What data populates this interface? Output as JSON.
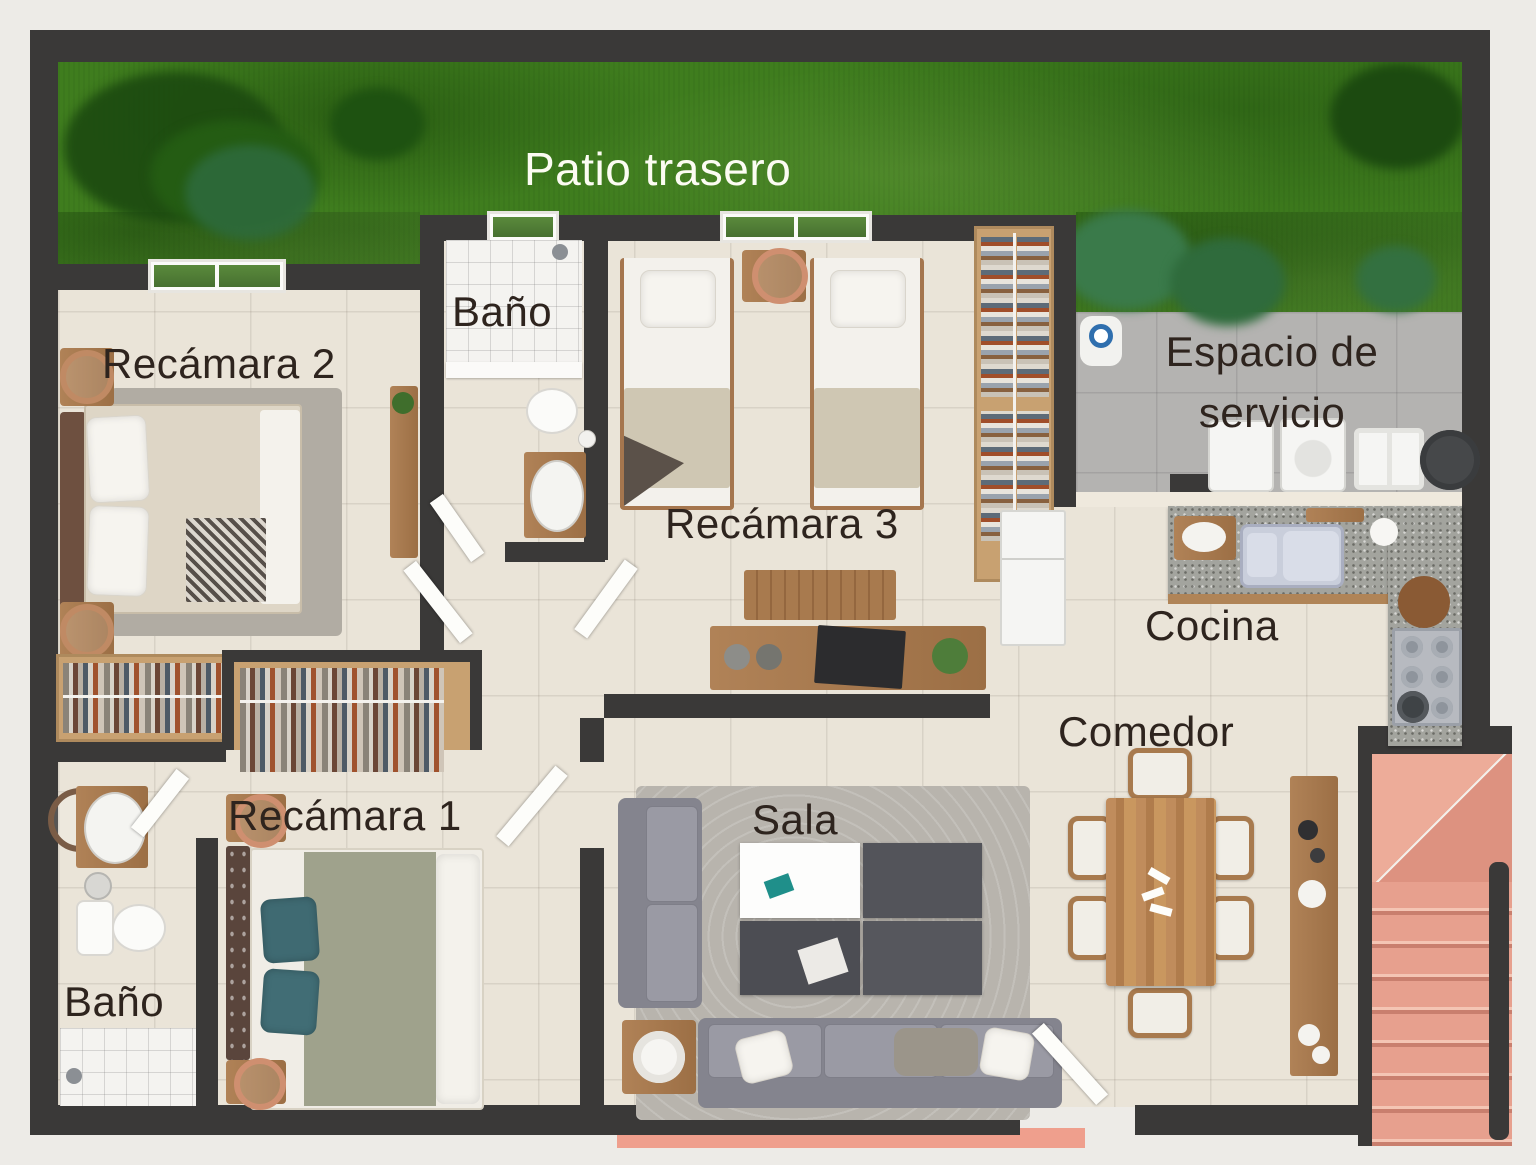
{
  "title": "Planta arquitectónica de casa (render 3D, vista superior)",
  "rooms": {
    "patio": {
      "label": "Patio trasero"
    },
    "bano_top": {
      "label": "Baño"
    },
    "recamara2": {
      "label": "Recámara 2"
    },
    "recamara3": {
      "label": "Recámara 3"
    },
    "espacio_servicio": {
      "line1": "Espacio de",
      "line2": "servicio"
    },
    "cocina": {
      "label": "Cocina"
    },
    "comedor": {
      "label": "Comedor"
    },
    "sala": {
      "label": "Sala"
    },
    "recamara1": {
      "label": "Recámara 1"
    },
    "bano_bottom": {
      "label": "Baño"
    }
  },
  "palette": {
    "wall": "#3a3938",
    "grass": "#3f7d1e",
    "floor_tile": "#eae4d8",
    "concrete": "#b4b3b1",
    "stairs_terracotta": "#e7a08e",
    "wood": "#a87a4e",
    "sofa_gray": "#8f8f99",
    "teal_pillow": "#3f6a72",
    "label_dark": "#2e241e",
    "label_light": "#fcfcf2"
  }
}
